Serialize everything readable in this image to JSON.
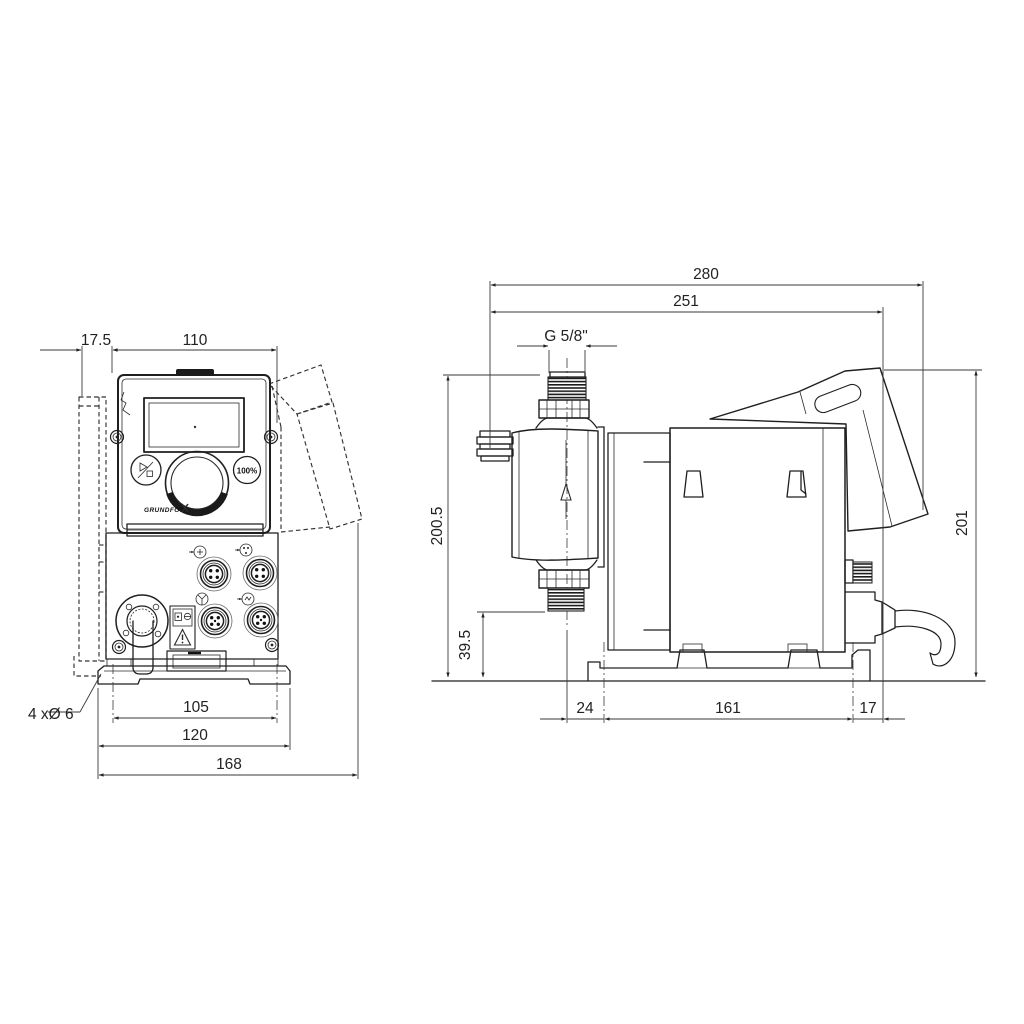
{
  "drawing": {
    "title": "Dosing pump dimensional drawing",
    "front_view": {
      "dims": {
        "offset_top": "17.5",
        "width_top": "110",
        "hole_spacing": "105",
        "plate_width": "120",
        "total_width": "168",
        "mounting_holes": "4 xØ 6"
      },
      "panel": {
        "button_100": "100%",
        "logo": "GRUNDFOS"
      }
    },
    "side_view": {
      "dims": {
        "total_length": "280",
        "length_to_cable": "251",
        "thread": "G 5/8\"",
        "total_height": "200.5",
        "valve_height": "39.5",
        "right_height": "201",
        "center_to_hole": "24",
        "hole_spacing": "161",
        "edge_offset": "17"
      }
    }
  }
}
